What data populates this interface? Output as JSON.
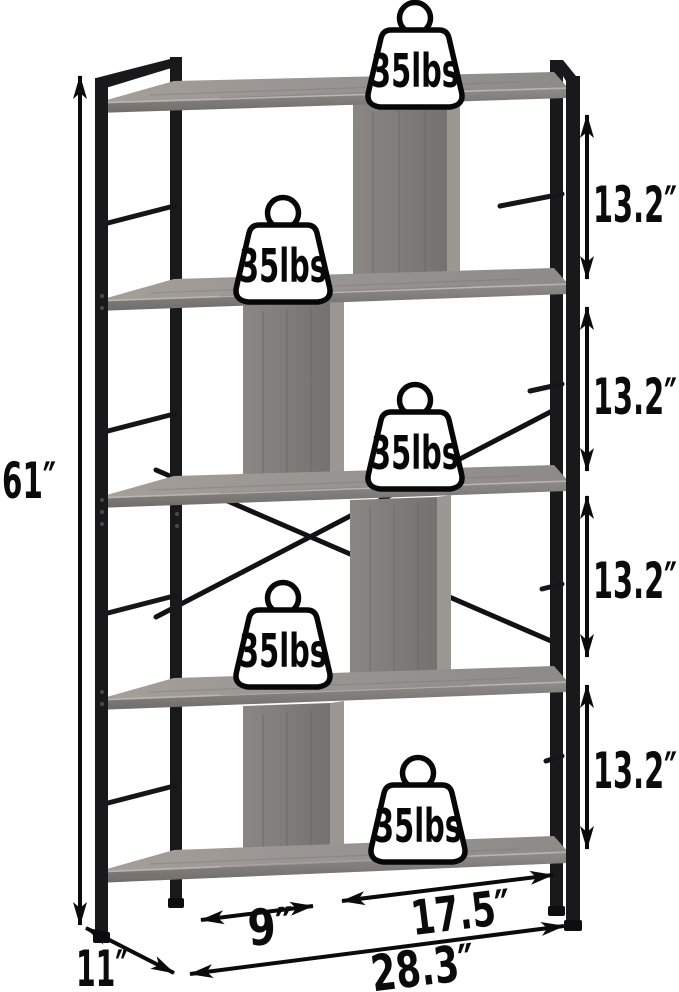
{
  "diagram": {
    "subject": "5-tier bookshelf with dimension annotations",
    "icons": {
      "weight_badge": "weight-icon"
    }
  },
  "badges": [
    {
      "label": "35lbs"
    },
    {
      "label": "35lbs"
    },
    {
      "label": "35lbs"
    },
    {
      "label": "35lbs"
    },
    {
      "label": "35lbs"
    }
  ],
  "dimensions": {
    "height": {
      "label": "61″"
    },
    "gaps": [
      {
        "label": "13.2″"
      },
      {
        "label": "13.2″"
      },
      {
        "label": "13.2″"
      },
      {
        "label": "13.2″"
      }
    ],
    "cubby_width": {
      "label": "9″"
    },
    "shelf_width": {
      "label": "17.5″"
    },
    "total_width": {
      "label": "28.3″"
    },
    "depth": {
      "label": "11″"
    }
  },
  "colors": {
    "background": "#ffffff",
    "frame_black": "#19191b",
    "wood_light": "#a49f9a",
    "wood_mid": "#8b8885",
    "wood_dark": "#716e6c",
    "annotation": "#0b0b0b"
  }
}
